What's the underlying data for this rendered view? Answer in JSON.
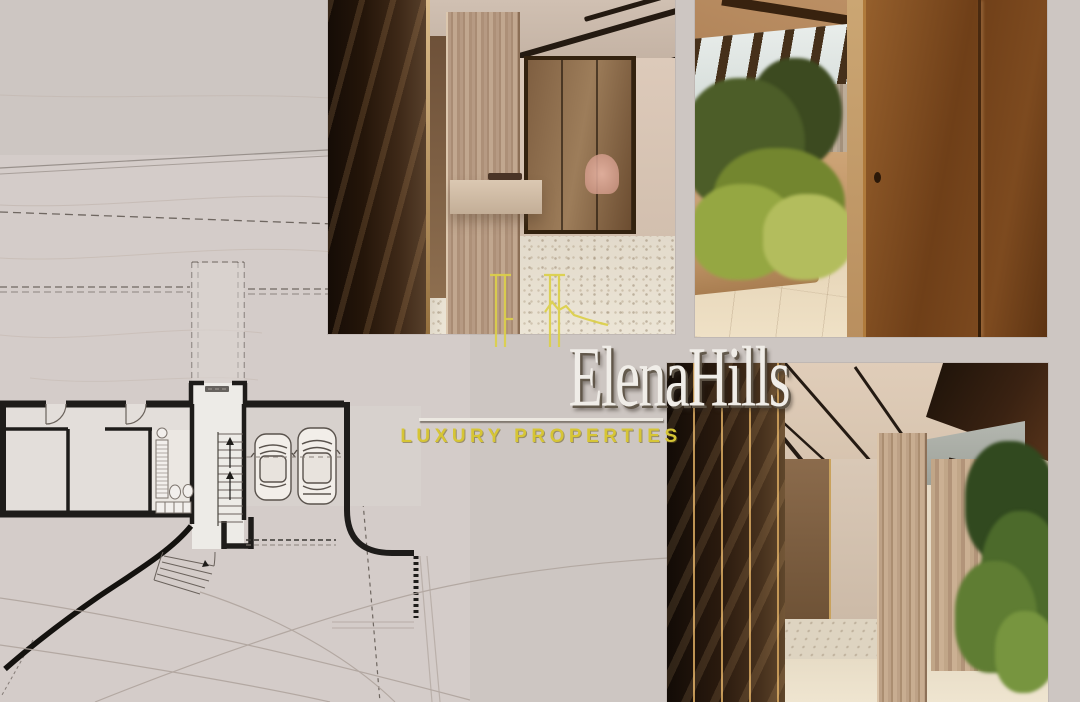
{
  "canvas": {
    "width": 1080,
    "height": 702,
    "background_color": "#cdc6c2"
  },
  "brand": {
    "name": "ElenaHills",
    "tagline": "LUXURY PROPERTIES",
    "name_color": "#f0ede8",
    "tagline_color": "#d6c535",
    "monogram_color": "#dcd04a",
    "monogram_icon": "eh-mountain-monogram"
  },
  "floor_plan": {
    "kind": "basement-garage-site-plan",
    "elements": [
      "rooms",
      "bathroom",
      "staircase",
      "elevator-label-mark",
      "two-parked-cars",
      "entry-steps",
      "curved-retaining-wall",
      "driveway-contours",
      "dashed-setback-lines"
    ],
    "wall_color": "#1e1c1a",
    "paper_color": "#d6cfcb"
  },
  "photos": [
    {
      "id": "dressing-room",
      "label": "walk-in-closet-render"
    },
    {
      "id": "entrance-hall",
      "label": "copper-door-entry-render"
    },
    {
      "id": "lobby-corridor",
      "label": "wardrobe-corridor-render"
    }
  ]
}
